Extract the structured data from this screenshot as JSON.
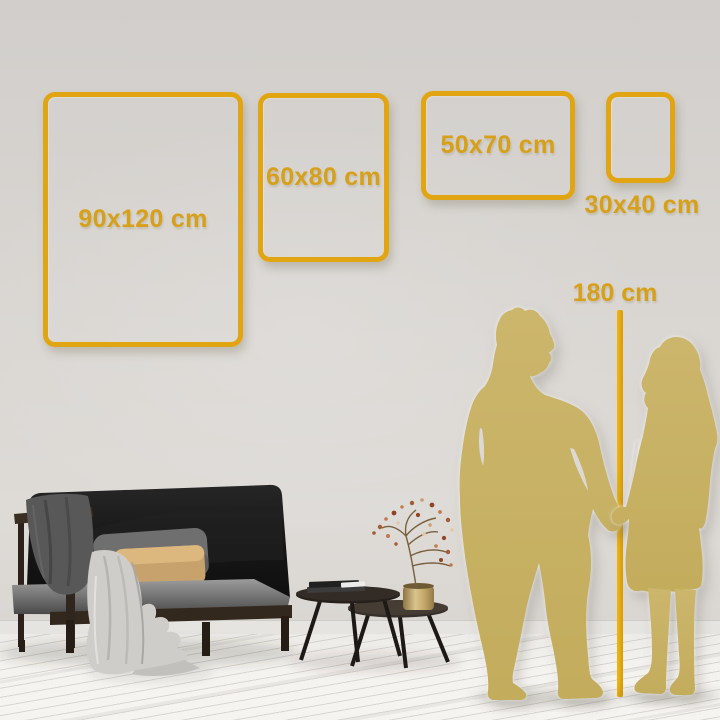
{
  "frames": [
    {
      "id": "90x120",
      "label": "90x120 cm",
      "orientation": "portrait"
    },
    {
      "id": "60x80",
      "label": "60x80 cm",
      "orientation": "portrait"
    },
    {
      "id": "50x70",
      "label": "50x70 cm",
      "orientation": "landscape"
    },
    {
      "id": "30x40",
      "label": "30x40 cm",
      "orientation": "portrait"
    }
  ],
  "height_reference": {
    "label": "180 cm"
  },
  "colors": {
    "frame_gold": "#E2A512",
    "label_gold": "#D7A01B",
    "line_gold": "#E0A40F",
    "silhouette_gold": "#C8B164",
    "wall": "#D9D6D2",
    "floor": "#F3F1EE"
  },
  "scene": {
    "silhouettes": [
      "man",
      "woman"
    ],
    "furniture": [
      "sofa",
      "dark-throw-blanket",
      "light-throw-blanket",
      "gray-pillow",
      "tan-pillow",
      "coffee-table-large",
      "coffee-table-small",
      "books-stack",
      "brass-vase",
      "dried-branch"
    ]
  }
}
